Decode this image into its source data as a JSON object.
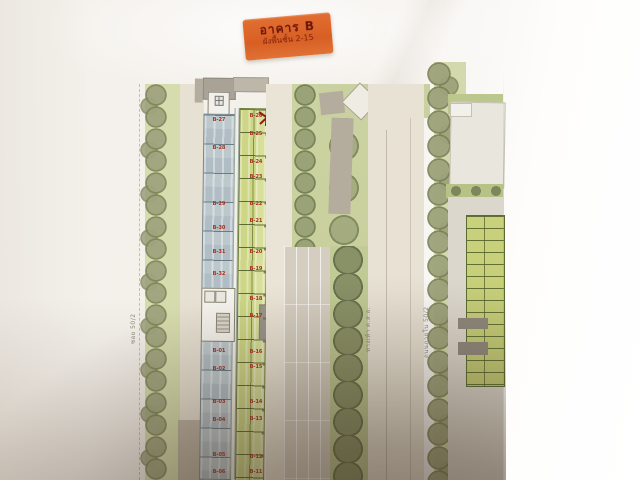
{
  "photo": {
    "description": "photo of a printed architectural site / floor plan sheet",
    "paper_color": "#f3efe9",
    "shadow_color": "#342618"
  },
  "sticker": {
    "title": "อาคาร B",
    "subtitle": "ผังพื้นชั้น 2-15",
    "bg_color": "#d85f24",
    "text_color": "#6e150b"
  },
  "marker": {
    "shape": "hand-drawn star",
    "color": "#8e2117"
  },
  "building_b": {
    "label_color": "#a63020",
    "left_column_upper": [
      "B-27",
      "B-28",
      "B-29",
      "B-30",
      "B-31",
      "B-32"
    ],
    "left_column_lower": [
      "B-01",
      "B-02",
      "B-03",
      "B-04",
      "B-05",
      "B-06"
    ],
    "right_column": [
      "B-26",
      "B-25",
      "B-24",
      "B-23",
      "B-22",
      "B-21",
      "B-20",
      "B-19",
      "B-18",
      "B-17",
      "B-16",
      "B-15",
      "B-14",
      "B-13",
      "B-12",
      "B-11"
    ],
    "unit_fill_left": "#b0bdc4",
    "unit_fill_right": "#cdd685"
  },
  "road_labels": {
    "left_boundary": "ซอย 50/2",
    "center_road": "ทางเท้า ค.ส.ล.",
    "right_road": "ถนนภายใน 50/2"
  },
  "landscape": {
    "tree_color": "#9ea47e",
    "green_band_color": "#d6dcae"
  }
}
